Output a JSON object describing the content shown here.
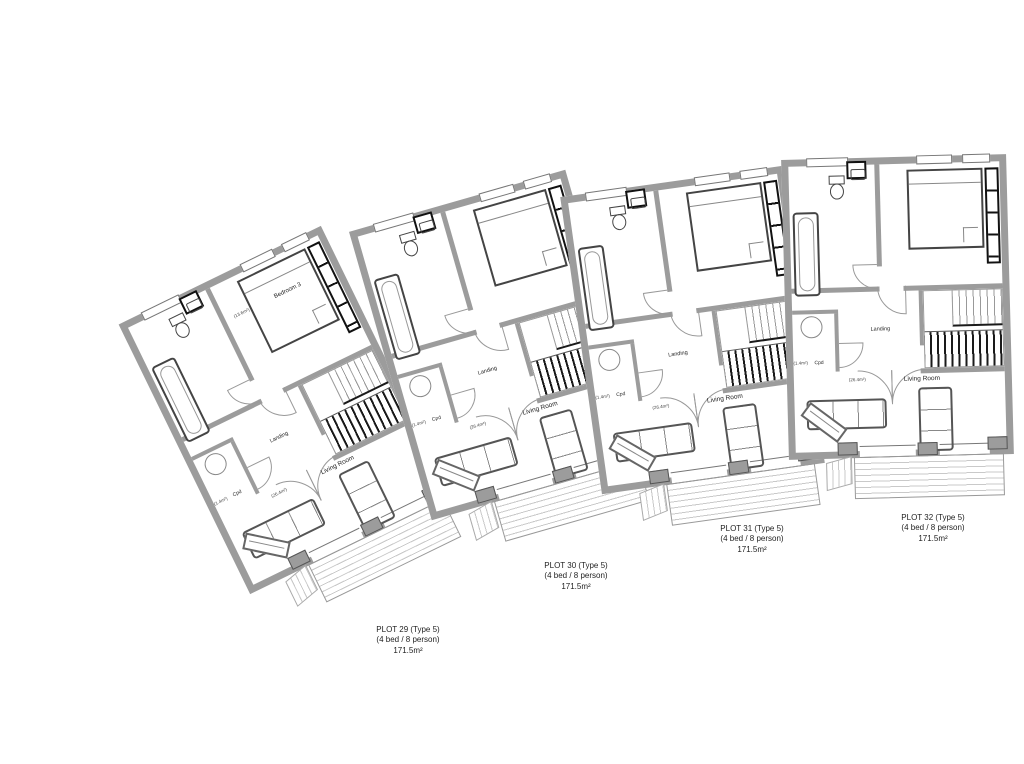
{
  "colors": {
    "wall": "#9c9c9c",
    "line": "#555555",
    "dark": "#141414",
    "deck_line": "#c9c9c9",
    "label": "#1f1f1f"
  },
  "units": [
    {
      "name": "plot-29",
      "x": 173,
      "y": 260,
      "rotation": -26,
      "rooms": {
        "bedroom": "Bedroom 3",
        "bedroom_sub": "(13.6m²)",
        "landing": "Landing",
        "cpd": "Cpd",
        "cpd_sub": "(1.4m²)",
        "living": "Living Room",
        "living_sub": "(26.4m²)"
      },
      "label": {
        "line1": "PLOT 29 (Type 5)",
        "line2": "(4 bed / 8 person)",
        "line3": "171.5m²",
        "x": 408,
        "y": 625
      }
    },
    {
      "name": "plot-30",
      "x": 386,
      "y": 195,
      "rotation": -16,
      "rooms": {
        "bedroom": "",
        "bedroom_sub": "",
        "landing": "Landing",
        "cpd": "Cpd",
        "cpd_sub": "(1.4m²)",
        "living": "Living Room",
        "living_sub": "(26.4m²)"
      },
      "label": {
        "line1": "PLOT 30 (Type 5)",
        "line2": "(4 bed / 8 person)",
        "line3": "171.5m²",
        "x": 576,
        "y": 561
      }
    },
    {
      "name": "plot-31",
      "x": 580,
      "y": 180,
      "rotation": -8,
      "rooms": {
        "bedroom": "",
        "bedroom_sub": "",
        "landing": "Landing",
        "cpd": "Cpd",
        "cpd_sub": "(1.4m²)",
        "living": "Living Room",
        "living_sub": "(26.4m²)"
      },
      "label": {
        "line1": "PLOT 31 (Type 5)",
        "line2": "(4 bed / 8 person)",
        "line3": "171.5m²",
        "x": 752,
        "y": 524
      }
    },
    {
      "name": "plot-32",
      "x": 785,
      "y": 157,
      "rotation": -1.5,
      "rooms": {
        "bedroom": "",
        "bedroom_sub": "",
        "landing": "Landing",
        "cpd": "Cpd",
        "cpd_sub": "(1.4m²)",
        "living": "Living Room",
        "living_sub": "(26.4m²)"
      },
      "label": {
        "line1": "PLOT 32 (Type 5)",
        "line2": "(4 bed / 8 person)",
        "line3": "171.5m²",
        "x": 933,
        "y": 513
      }
    }
  ]
}
